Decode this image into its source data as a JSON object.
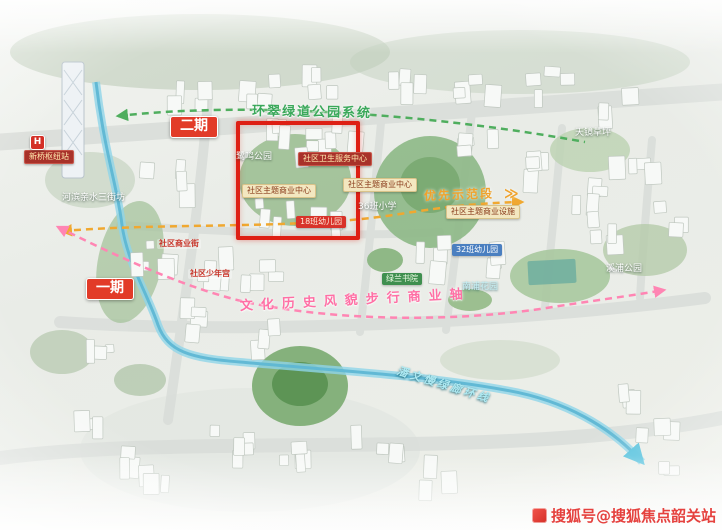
{
  "map": {
    "highlight_color": "#de1f14",
    "route_colors": {
      "greenway": "#4fae5e",
      "priority": "#f0a830",
      "heritage_axis": "#ff85b3",
      "river_loop": "#5fb8d4"
    },
    "labels": [
      {
        "id": "phase-2-badge",
        "text": "二期",
        "class": "badge-red",
        "x": 170,
        "y": 116
      },
      {
        "id": "phase-1-badge",
        "text": "一期",
        "class": "badge-red",
        "x": 86,
        "y": 278
      },
      {
        "id": "greenway-route-label",
        "text": "环翠绿道公园系统",
        "class": "text-green-route",
        "x": 252,
        "y": 104,
        "rotate": 1
      },
      {
        "id": "park-label-luming",
        "text": "鹭鸣公园",
        "class": "text-white",
        "x": 236,
        "y": 152
      },
      {
        "id": "health-center-badge",
        "text": "社区卫生服务中心",
        "class": "badge-darkred",
        "x": 298,
        "y": 152
      },
      {
        "id": "commerce-center-badge-1",
        "text": "社区主题商业中心",
        "class": "badge-yellow",
        "x": 242,
        "y": 184
      },
      {
        "id": "commerce-center-badge-2",
        "text": "社区主题商业中心",
        "class": "badge-yellow",
        "x": 343,
        "y": 178
      },
      {
        "id": "kindergarten-18-badge",
        "text": "18班幼儿园",
        "class": "badge-brightred",
        "x": 296,
        "y": 216
      },
      {
        "id": "primary-school-36-label",
        "text": "36班小学",
        "class": "text-white",
        "x": 358,
        "y": 202
      },
      {
        "id": "priority-demo-section-label",
        "text": "优先示范段",
        "class": "text-orange-route",
        "x": 424,
        "y": 189,
        "rotate": -2
      },
      {
        "id": "priority-arrow",
        "text": "≫",
        "class": "text-orange-route",
        "x": 504,
        "y": 186,
        "size": 14
      },
      {
        "id": "commerce-facility-badge",
        "text": "社区主题商业设施",
        "class": "badge-yellow",
        "x": 446,
        "y": 205
      },
      {
        "id": "lawn-label",
        "text": "天镜草坪",
        "class": "text-white",
        "x": 575,
        "y": 128
      },
      {
        "id": "kindergarten-32-badge",
        "text": "32班幼儿园",
        "class": "badge-blue",
        "x": 452,
        "y": 244
      },
      {
        "id": "academy-badge",
        "text": "绿兰书院",
        "class": "badge-green",
        "x": 382,
        "y": 273
      },
      {
        "id": "nanpu-garden-label",
        "text": "南浦花园",
        "class": "text-cyan",
        "x": 462,
        "y": 282
      },
      {
        "id": "xipu-park-label",
        "text": "溪浦公园",
        "class": "text-white",
        "x": 606,
        "y": 264
      },
      {
        "id": "commercial-street-label",
        "text": "社区商业街",
        "class": "text-red",
        "x": 157,
        "y": 239
      },
      {
        "id": "youth-center-label",
        "text": "社区少年宫",
        "class": "text-red",
        "x": 188,
        "y": 269
      },
      {
        "id": "heritage-walk-axis-label",
        "text": "文化历史风貌步行商业轴",
        "class": "text-pink-route",
        "x": 240,
        "y": 299,
        "rotate": -3
      },
      {
        "id": "greenway-loop-label",
        "text": "潘文慢绿廊环线",
        "class": "text-cyan-route",
        "x": 397,
        "y": 364,
        "rotate": 17
      },
      {
        "id": "riverside-blocks-label",
        "text": "河滨亲水三街坊",
        "class": "text-white",
        "x": 62,
        "y": 193
      },
      {
        "id": "metro-station-badge",
        "text": "新桥枢纽站",
        "class": "badge-darkred",
        "x": 24,
        "y": 150
      }
    ],
    "metro_icon": {
      "glyph": "H"
    }
  },
  "watermark": {
    "text": "搜狐号@搜狐焦点韶关站"
  }
}
